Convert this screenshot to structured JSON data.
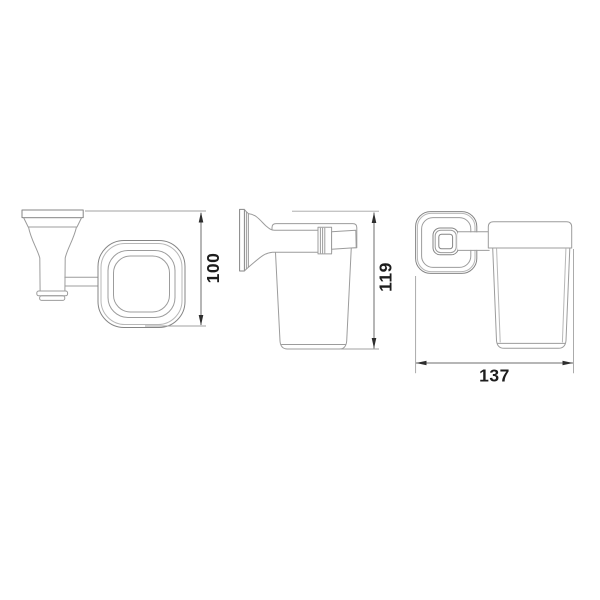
{
  "views": {
    "top": {
      "dimension_label": "100"
    },
    "side": {
      "dimension_label": "119"
    },
    "front": {
      "dimension_label": "137"
    }
  },
  "colors": {
    "background": "#ffffff",
    "drawing_line": "#9c9c9c",
    "dimension_line": "#6e6e6e",
    "arrow": "#2e2e2e",
    "dimension_text": "#1d1d1d"
  }
}
